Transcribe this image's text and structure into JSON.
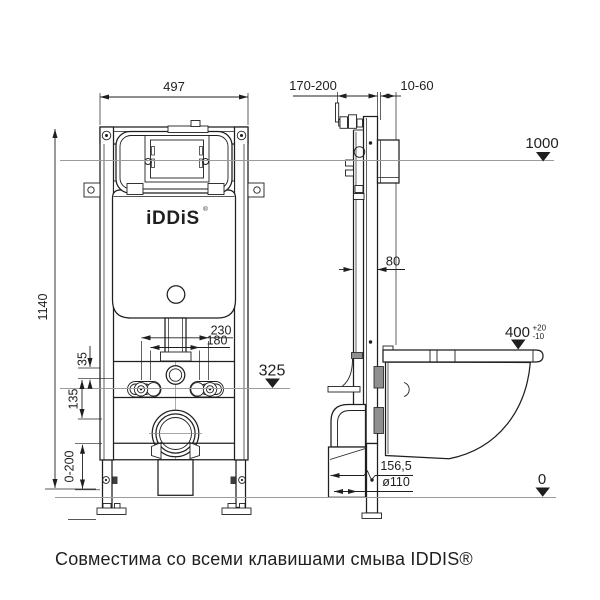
{
  "drawing": {
    "caption": "Совместима со всеми клавишами смыва IDDIS®",
    "logo": {
      "text": "iDDiS",
      "registered_mark": "®"
    },
    "colors": {
      "line": "#1f1f1f",
      "level-line": "#9b9b9b",
      "fill-gray": "#8f8f8f",
      "background": "#ffffff"
    },
    "dimensions": {
      "front_width": "497",
      "frame_height": "1140",
      "wall_distance": "170-200",
      "finish_thickness": "10-60",
      "flush_plate_level": "1000",
      "frame_depth": "80",
      "stud_spacing_outer": "230",
      "stud_spacing_inner": "180",
      "inlet_offset": "35",
      "outlet_axis_level": "325",
      "bracket_offset": "135",
      "bowl_height": "400",
      "bowl_height_tolerance_plus": "+20",
      "bowl_height_tolerance_minus": "-10",
      "leg_adjustment": "0-200",
      "outlet_horizontal": "156,5",
      "waste_diameter": "ø110",
      "floor_level": "0"
    }
  }
}
